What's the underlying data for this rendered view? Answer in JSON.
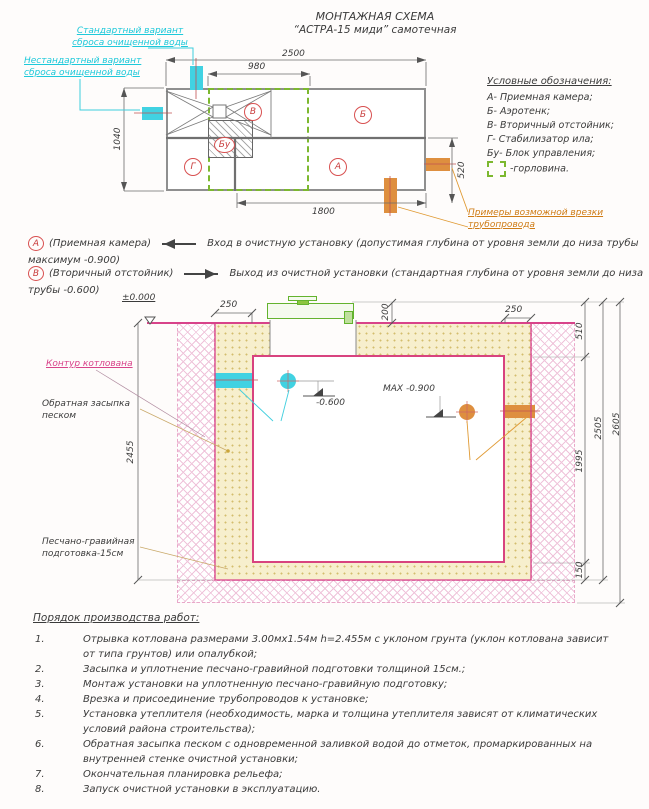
{
  "title": {
    "l1": "МОНТАЖНАЯ СХЕМА",
    "l2": "“АСТРА-15 миди” самотечная"
  },
  "plan": {
    "std_label": "Стандартный вариант\nсброса очищенной воды",
    "nonstd_label": "Нестандартный вариант\nсброса очищенной воды",
    "tap_label": "Примеры возможной врезки\nтрубопровода",
    "zones": {
      "v": "В",
      "b": "Б",
      "bu": "Бу",
      "g": "Г",
      "a": "А"
    },
    "dims": {
      "w2500": "2500",
      "w980": "980",
      "h1040": "1040",
      "h520": "520",
      "w1800": "1800"
    }
  },
  "legend": {
    "title": "Условные обозначения:",
    "items": [
      "А- Приемная камера;",
      "Б- Аэротенк;",
      "В- Вторичный отстойник;",
      "Г- Стабилизатор ила;",
      "Бу- Блок управления;"
    ],
    "gorlovina": "-горловина."
  },
  "notes": [
    {
      "marker": "А",
      "name": "(Приемная камера)",
      "line1": "Вход в очистную установку (допустимая глубина от уровня земли до низа трубы",
      "line2": "максимум -0.900)"
    },
    {
      "marker": "В",
      "name": "(Вторичный отстойник)",
      "line1": "Выход из очистной установки (стандартная глубина от уровня земли до низа",
      "line2": "трубы -0.600)"
    }
  ],
  "section": {
    "zero": "±0.000",
    "pit_contour": "Контур котлована",
    "backfill": "Обратная засыпка\nпеском",
    "sand_prep": "Песчано-гравийная\nподготовка-15см",
    "discharge": "Варианты сброса\nочищенной воды",
    "tap": "Примеры возможной\nврезки трубопровода",
    "lvl600": "-0.600",
    "lvl900": "МАХ -0.900",
    "dims": {
      "l250": "250",
      "r250": "250",
      "d200": "200",
      "d510": "510",
      "d1995": "1995",
      "d150": "150",
      "d2505": "2505",
      "d2605": "2605",
      "d2455": "2455"
    }
  },
  "procedure": {
    "title": "Порядок производства работ:",
    "items": [
      {
        "n": "1.",
        "t": "Отрывка котлована размерами 3.00мх1.54м h=2.455м с уклоном грунта (уклон котлована зависит\nот типа грунтов) или опалубкой;"
      },
      {
        "n": "2.",
        "t": "Засыпка и уплотнение песчано-гравийной подготовки толщиной 15см.;"
      },
      {
        "n": "3.",
        "t": "Монтаж установки на уплотненную песчано-гравийную подготовку;"
      },
      {
        "n": "4.",
        "t": "Врезка и присоединение трубопроводов к установке;"
      },
      {
        "n": "5.",
        "t": "Установка утеплителя (необходимость, марка и толщина утеплителя зависят от климатических\nусловий района строительства);"
      },
      {
        "n": "6.",
        "t": "Обратная засыпка песком с одновременной заливкой водой до отметок, промаркированных на\nвнутренней стенке очистной установки;"
      },
      {
        "n": "7.",
        "t": "Окончательная планировка рельефа;"
      },
      {
        "n": "8.",
        "t": "Запуск очистной установки в эксплуатацию."
      }
    ]
  }
}
